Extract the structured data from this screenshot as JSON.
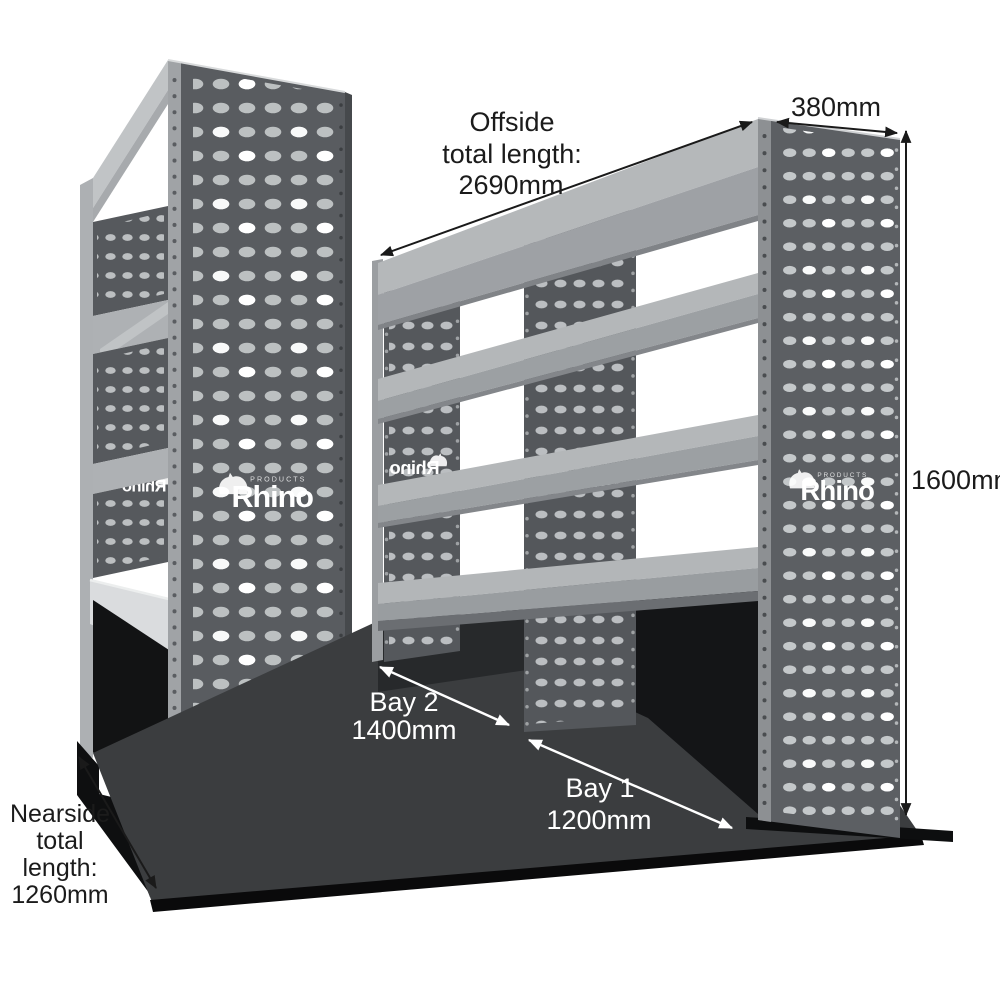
{
  "brand": {
    "name": "Rhino",
    "products_caption": "PRODUCTS"
  },
  "annotations": {
    "offside_length": {
      "line1": "Offside",
      "line2": "total length:",
      "line3": "2690mm"
    },
    "depth": {
      "value": "380mm"
    },
    "height": {
      "value": "1600mm"
    },
    "bay2": {
      "label": "Bay 2",
      "value": "1400mm"
    },
    "bay1": {
      "label": "Bay 1",
      "value": "1200mm"
    },
    "nearside_length": {
      "line1": "Nearside",
      "line2": "total",
      "line3": "length:",
      "line4": "1260mm"
    }
  },
  "colors": {
    "background": "#ffffff",
    "panel_dark": "#595c60",
    "shelf_light": "#b4b7b9",
    "floor": "#3b3d3f",
    "shadow_black": "#0d0e0f",
    "annotation_text": "#1b1b1b",
    "bay_text": "#ffffff"
  }
}
